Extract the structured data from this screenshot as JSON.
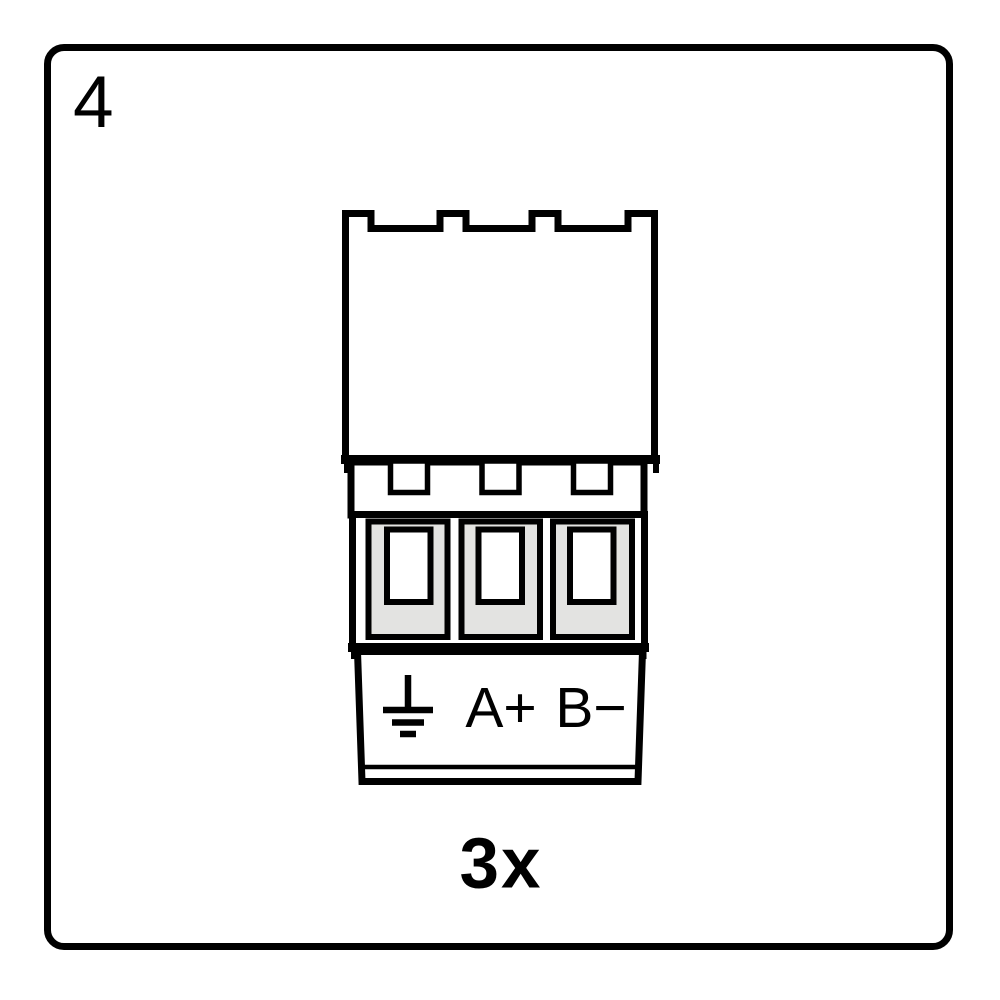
{
  "step": {
    "number": "4"
  },
  "diagram": {
    "type": "pluggable-terminal-block-connector",
    "terminal_count": 3,
    "labels": {
      "ground_icon": "earth-ground-icon",
      "a_plus": "A+",
      "b_minus": "B−"
    },
    "quantity": "3x",
    "colors": {
      "outline": "#000000",
      "background": "#ffffff",
      "terminal_fill": "#e3e3e1"
    }
  }
}
